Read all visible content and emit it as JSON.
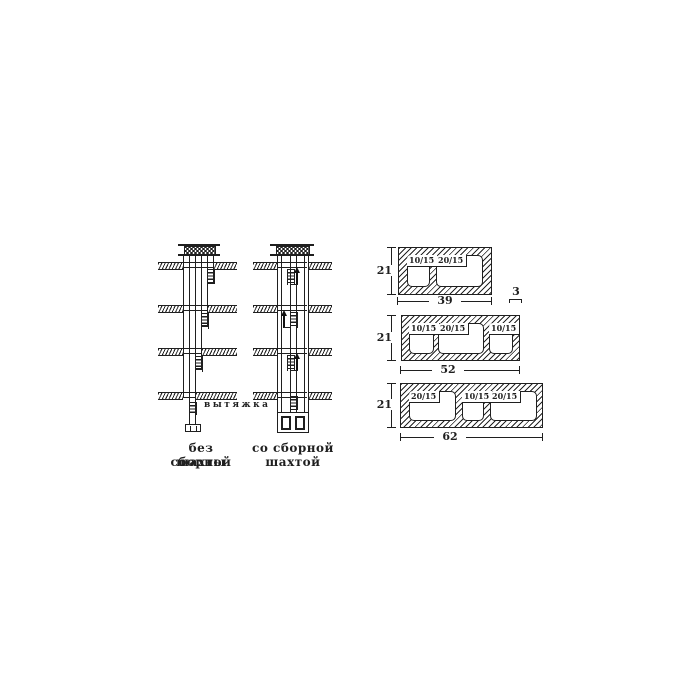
{
  "figure": {
    "background": "#ffffff",
    "ink": "#1f1f1f",
    "shafts": {
      "left": {
        "caption_line1": "без сборной",
        "caption_line2": "шахты",
        "annotation": "вытяжка"
      },
      "right": {
        "caption_line1": "со сборной",
        "caption_line2": "шахтой"
      }
    },
    "blocks": [
      {
        "height": "21",
        "width": "39",
        "wall": "3",
        "openings": [
          "10/15",
          "20/15"
        ]
      },
      {
        "height": "21",
        "width": "52",
        "openings": [
          "10/15",
          "20/15",
          "10/15"
        ]
      },
      {
        "height": "21",
        "width": "62",
        "openings": [
          "20/15",
          "10/15",
          "20/15"
        ]
      }
    ]
  }
}
